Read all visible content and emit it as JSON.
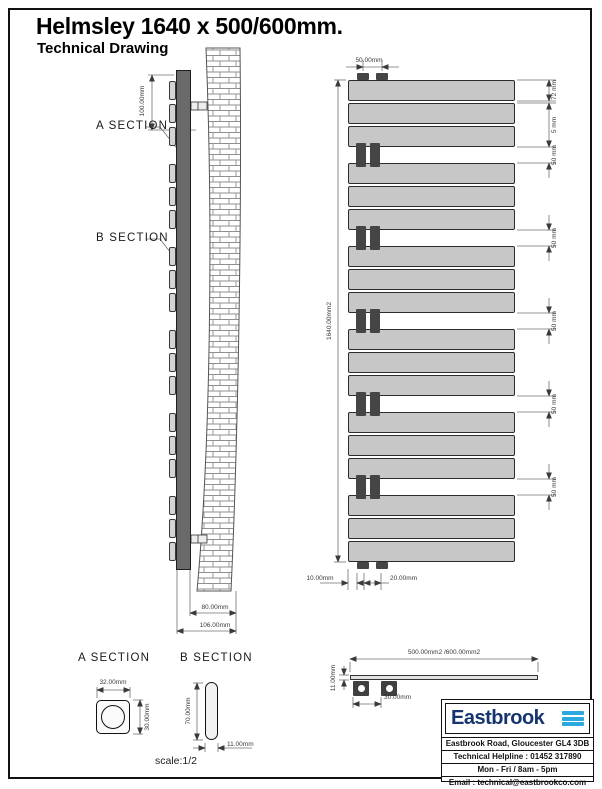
{
  "title": "Helmsley 1640 x 500/600mm.",
  "subtitle": "Technical Drawing",
  "scale": "scale:1/2",
  "side_view": {
    "a_section": "A SECTION",
    "b_section": "B SECTION",
    "wall_offset": "100.00mm",
    "depth": "80.00mm",
    "overall_depth": "106.00mm"
  },
  "front_view": {
    "tube_spacing": "50.00mm",
    "height": "1640.00mm2",
    "panel_height": "72 mm",
    "panel_gap": "5 mm",
    "group_gap": "50 mm",
    "bottom_offset": "10.00mm",
    "tube_gap": "20.00mm",
    "panel_groups": 6,
    "panels_per_group": 3
  },
  "section_a": {
    "title": "A SECTION",
    "width": "32.00mm",
    "height": "30.00mm"
  },
  "section_b": {
    "title": "B SECTION",
    "height": "70.00mm",
    "width": "11.00mm"
  },
  "top_view": {
    "width": "500.00mm2 /600.00mm2",
    "depth": "11.00mm",
    "tube_pitch": "30.00mm"
  },
  "info_box": {
    "brand": "Eastbrook",
    "address": "Eastbrook Road, Gloucester GL4 3DB",
    "helpline": "Technical Helpline : 01452 317890",
    "hours": "Mon - Fri / 8am - 5pm",
    "email": "Email : technical@eastbrookco.com"
  },
  "colors": {
    "panel": "#c7c7c7",
    "tube": "#454545",
    "side_bar": "#6a6a6a",
    "dimension": "#707070",
    "brand_navy": "#16356e",
    "wave_blue": "#2aa9e0"
  }
}
